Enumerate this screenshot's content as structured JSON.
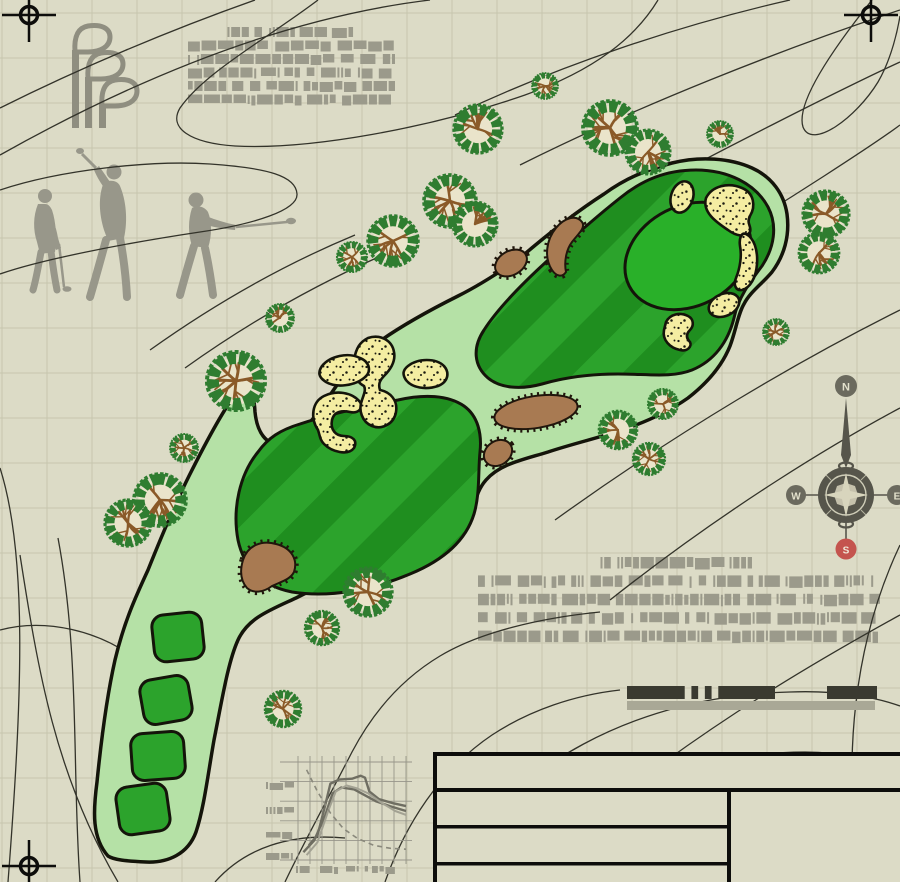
{
  "canvas": {
    "w": 900,
    "h": 882,
    "bg": "#dcdbc6"
  },
  "grid": {
    "spacing": 45,
    "offset_x": 2,
    "offset_y": 13,
    "color": "#c7c6ae"
  },
  "palette": {
    "contour": "#33332a",
    "rough": "#b5e1a6",
    "fairway": "#2ca32c",
    "fairway_stripe": "#1f8e1f",
    "green": "#29b029",
    "sand": "#f4eda2",
    "hazard": "#a87a52",
    "outline": "#14140a",
    "gray_art": "#98978a",
    "greek": "#9b9a8b",
    "scalebar_dark": "#3a3a30",
    "scalebar_light": "#a9a896"
  },
  "compass": {
    "north": "N",
    "east": "E",
    "south": "S",
    "west": "W",
    "body_color": "#56554b",
    "label_bg": "#6b6a5e",
    "south_bg": "#c4544e",
    "label_text": "#e3e1cc"
  },
  "greeked_blocks": [
    {
      "name": "spec-notes-top",
      "x": 188,
      "y": 27,
      "width": 207,
      "rows": 5,
      "row_pitch": 13.5,
      "row_h": 10,
      "title_w": 128,
      "seed": 7
    },
    {
      "name": "spec-notes-mid",
      "x": 478,
      "y": 557,
      "width": 402,
      "rows": 4,
      "row_pitch": 18.4,
      "row_h": 11.5,
      "title_w": 157,
      "seed": 23
    }
  ],
  "scale_bar": {
    "y": 686,
    "h": 13,
    "solid_segments": [
      {
        "x": 627,
        "w": 51
      },
      {
        "x": 725,
        "w": 50
      },
      {
        "x": 827,
        "w": 50
      }
    ],
    "striped_segment": {
      "x": 678,
      "w": 47,
      "bars": 7
    },
    "underbar": {
      "x": 627,
      "y": 701,
      "w": 248,
      "h": 9
    }
  },
  "map": {
    "trees": [
      {
        "x": 478,
        "y": 129,
        "r": 24
      },
      {
        "x": 545,
        "y": 86,
        "r": 13
      },
      {
        "x": 393,
        "y": 241,
        "r": 25
      },
      {
        "x": 450,
        "y": 201,
        "r": 26
      },
      {
        "x": 475,
        "y": 224,
        "r": 22
      },
      {
        "x": 610,
        "y": 128,
        "r": 27
      },
      {
        "x": 648,
        "y": 152,
        "r": 22
      },
      {
        "x": 720,
        "y": 134,
        "r": 13
      },
      {
        "x": 826,
        "y": 214,
        "r": 23
      },
      {
        "x": 819,
        "y": 253,
        "r": 20
      },
      {
        "x": 776,
        "y": 332,
        "r": 13
      },
      {
        "x": 663,
        "y": 404,
        "r": 15
      },
      {
        "x": 618,
        "y": 430,
        "r": 19
      },
      {
        "x": 649,
        "y": 459,
        "r": 16
      },
      {
        "x": 280,
        "y": 318,
        "r": 14
      },
      {
        "x": 352,
        "y": 257,
        "r": 15
      },
      {
        "x": 236,
        "y": 381,
        "r": 29
      },
      {
        "x": 184,
        "y": 448,
        "r": 14
      },
      {
        "x": 160,
        "y": 500,
        "r": 26
      },
      {
        "x": 128,
        "y": 523,
        "r": 23
      },
      {
        "x": 368,
        "y": 592,
        "r": 24
      },
      {
        "x": 322,
        "y": 628,
        "r": 17
      },
      {
        "x": 283,
        "y": 709,
        "r": 18
      }
    ],
    "tees": [
      {
        "x": 178,
        "y": 637,
        "w": 50,
        "h": 47,
        "rot": -6
      },
      {
        "x": 166,
        "y": 700,
        "w": 49,
        "h": 45,
        "rot": -10
      },
      {
        "x": 158,
        "y": 756,
        "w": 53,
        "h": 47,
        "rot": -4
      },
      {
        "x": 143,
        "y": 809,
        "w": 51,
        "h": 48,
        "rot": -8
      }
    ]
  },
  "chart_data": {
    "type": "line",
    "title": "",
    "xlabel": "",
    "ylabel": "",
    "x_range": [
      0,
      100
    ],
    "y_range": [
      0,
      100
    ],
    "grid": true,
    "axis_labels_greeked": true,
    "ytick_count": 4,
    "xtick_count": 4,
    "series": [
      {
        "name": "profile-a",
        "style": "solid-dark",
        "points": [
          [
            10,
            15
          ],
          [
            18,
            25
          ],
          [
            25,
            55
          ],
          [
            30,
            78
          ],
          [
            38,
            82
          ],
          [
            50,
            83
          ],
          [
            58,
            86
          ],
          [
            62,
            84
          ],
          [
            66,
            70
          ],
          [
            75,
            62
          ],
          [
            88,
            58
          ],
          [
            100,
            55
          ]
        ]
      },
      {
        "name": "profile-b",
        "style": "solid-dark",
        "points": [
          [
            5,
            8
          ],
          [
            15,
            20
          ],
          [
            25,
            45
          ],
          [
            32,
            68
          ],
          [
            40,
            74
          ],
          [
            52,
            72
          ],
          [
            62,
            66
          ],
          [
            72,
            60
          ],
          [
            85,
            55
          ],
          [
            100,
            50
          ]
        ]
      },
      {
        "name": "profile-c",
        "style": "solid-light",
        "points": [
          [
            8,
            5
          ],
          [
            18,
            18
          ],
          [
            28,
            50
          ],
          [
            35,
            70
          ],
          [
            45,
            76
          ],
          [
            55,
            73
          ],
          [
            65,
            68
          ],
          [
            78,
            58
          ],
          [
            90,
            50
          ],
          [
            100,
            46
          ]
        ]
      },
      {
        "name": "profile-d",
        "style": "dashed",
        "points": [
          [
            8,
            92
          ],
          [
            18,
            70
          ],
          [
            30,
            48
          ],
          [
            42,
            32
          ],
          [
            55,
            22
          ],
          [
            70,
            15
          ],
          [
            85,
            12
          ],
          [
            100,
            11
          ]
        ]
      }
    ],
    "plot": {
      "x": 298,
      "y": 762,
      "w": 108,
      "h": 98,
      "vlines": 9,
      "hlines": 5
    },
    "ytick_y": [
      786,
      811,
      836,
      857
    ],
    "xtick_x": [
      296,
      320,
      346,
      372
    ]
  },
  "title_block": {
    "rows_left": 3,
    "note": "empty drawing title block"
  }
}
